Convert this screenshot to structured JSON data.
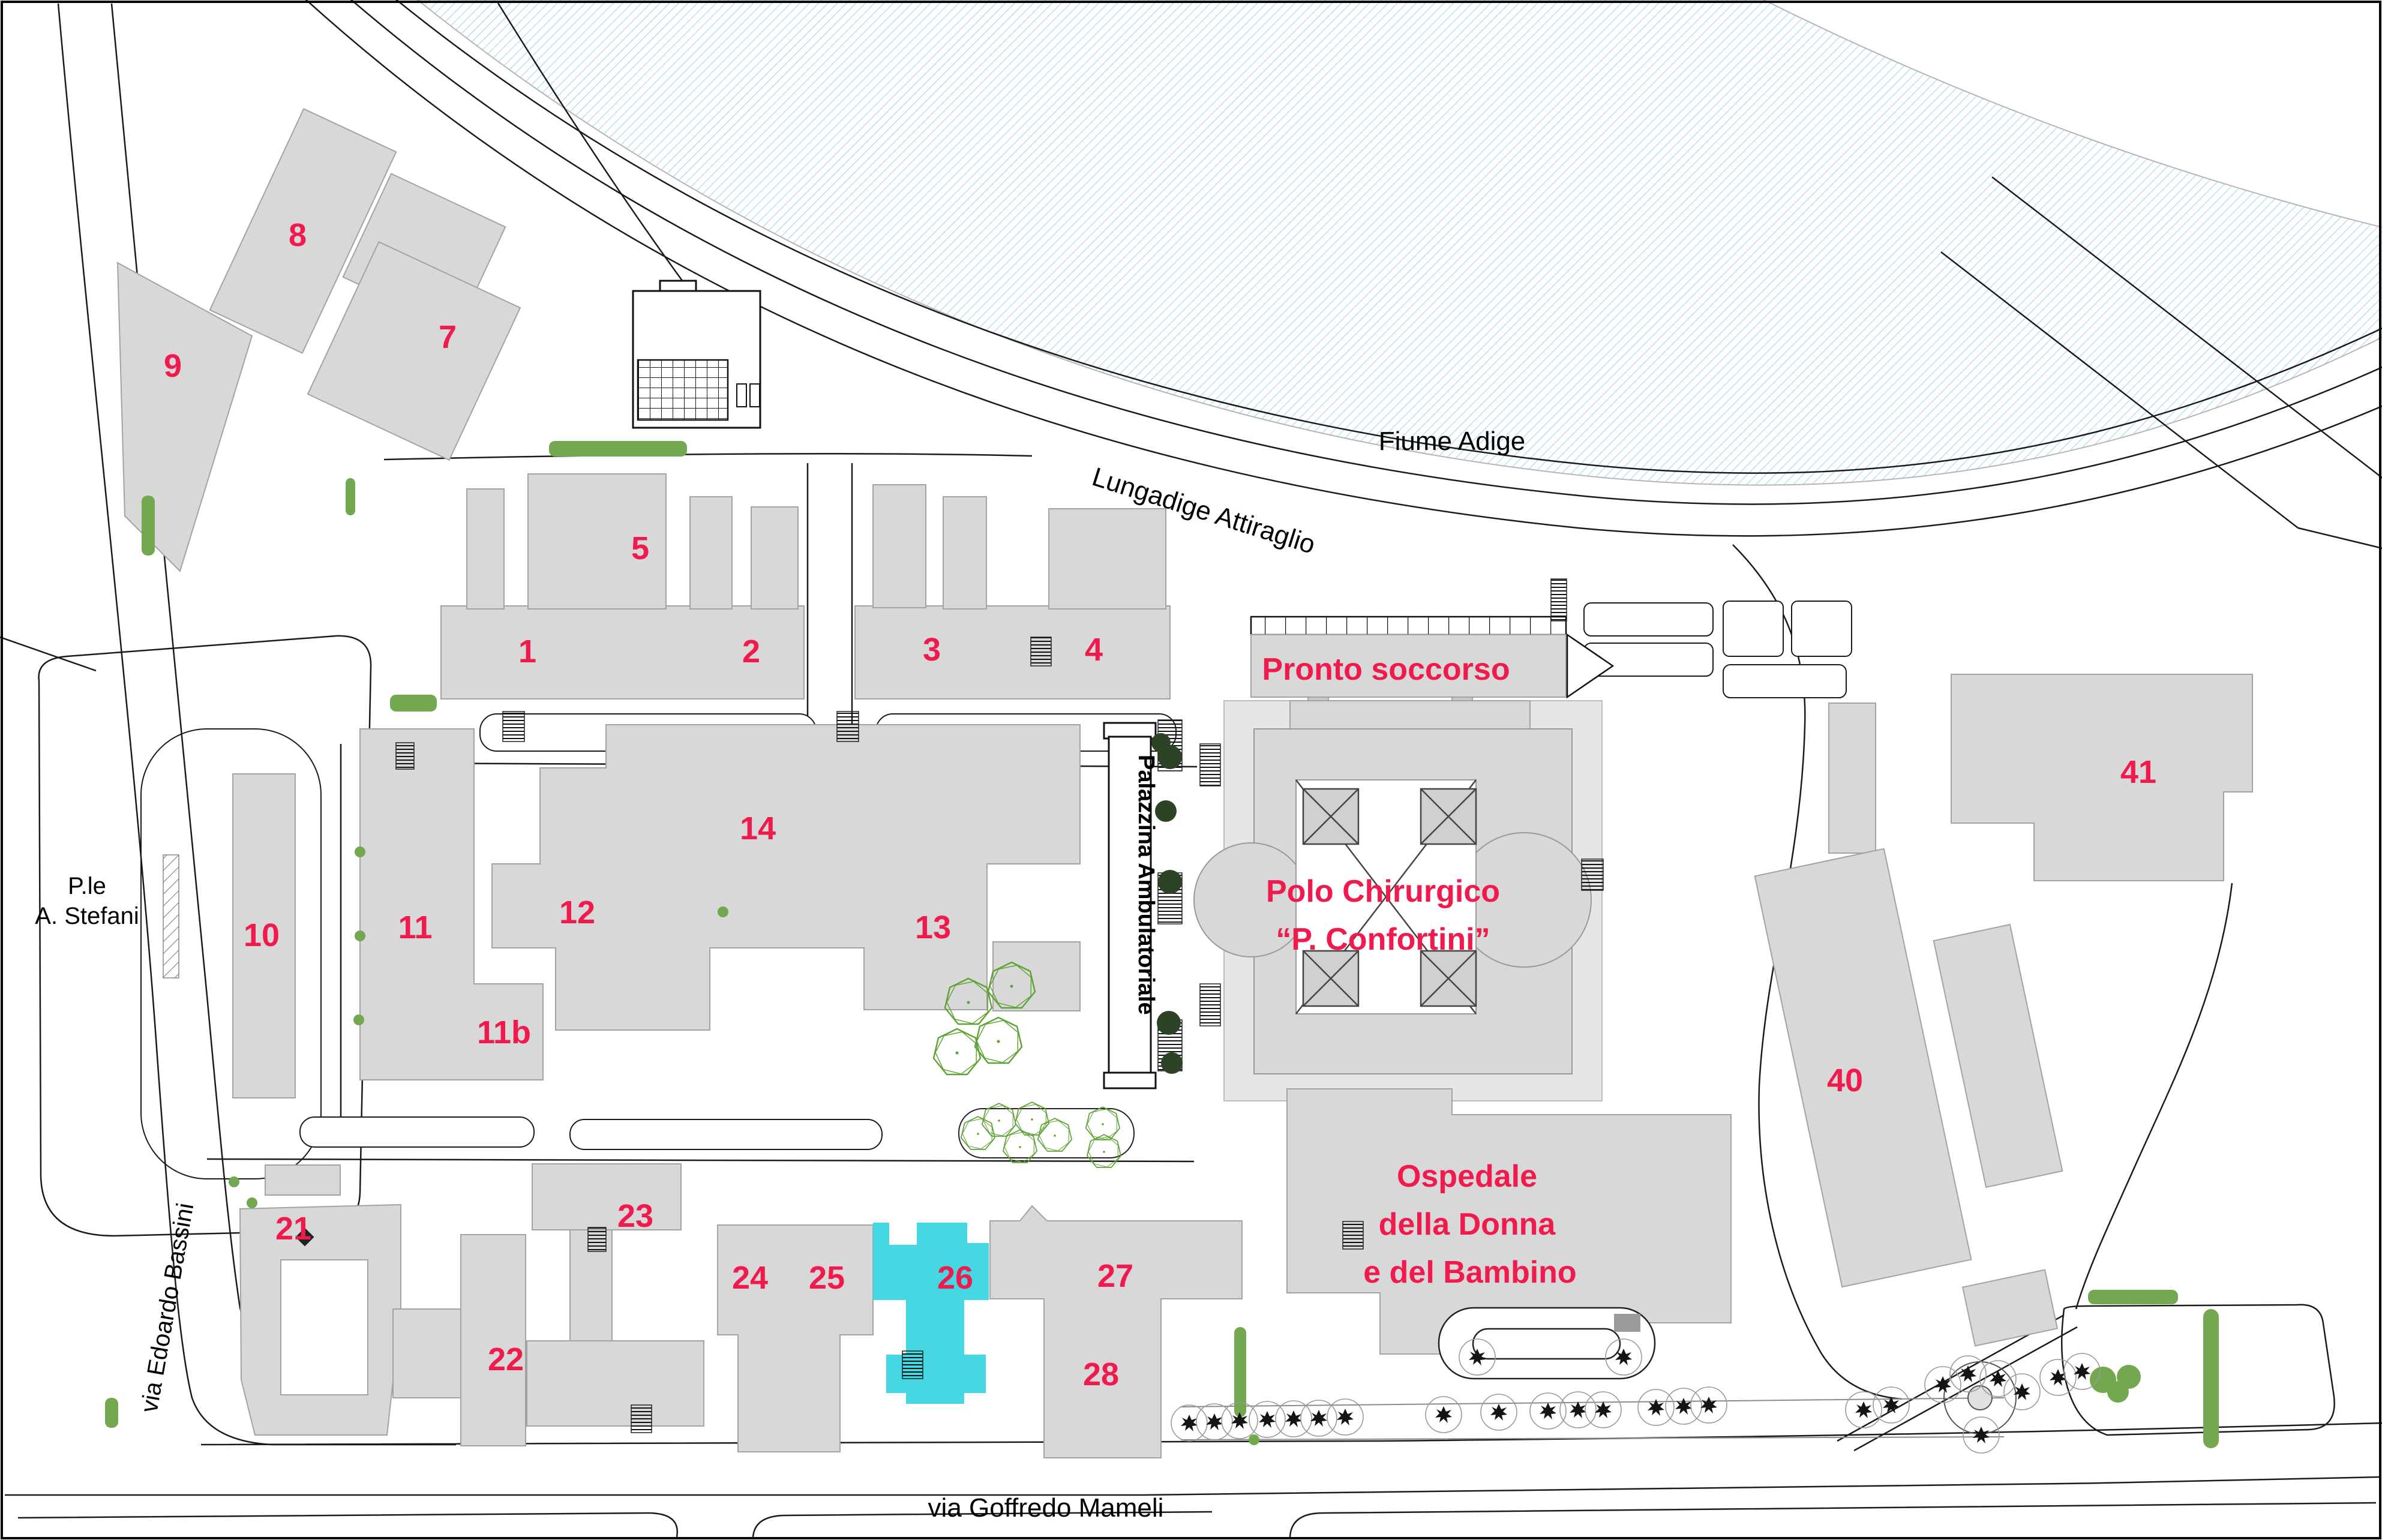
{
  "map": {
    "region_labels": {
      "river": "Fiume Adige"
    },
    "streets": {
      "lungadige_attiraglio": "Lungadige Attiraglio",
      "via_edoardo_bassini": "via Edoardo Bassini",
      "via_goffredo_mameli": "via Goffredo Mameli",
      "piazzale_line1": "P.le",
      "piazzale_line2": "A. Stefani"
    },
    "facility_labels": {
      "palazzina_ambulatoriale": "Palazzina Ambulatoriale",
      "pronto_soccorso": "Pronto soccorso",
      "polo_chirurgico_line1": "Polo Chirurgico",
      "polo_chirurgico_line2": "“P. Confortini”",
      "ospedale_donna_line1": "Ospedale",
      "ospedale_donna_line2": "della Donna",
      "ospedale_donna_line3": "e del Bambino"
    },
    "buildings": [
      {
        "id": "1",
        "label": "1"
      },
      {
        "id": "2",
        "label": "2"
      },
      {
        "id": "3",
        "label": "3"
      },
      {
        "id": "4",
        "label": "4"
      },
      {
        "id": "5",
        "label": "5"
      },
      {
        "id": "7",
        "label": "7"
      },
      {
        "id": "8",
        "label": "8"
      },
      {
        "id": "9",
        "label": "9"
      },
      {
        "id": "10",
        "label": "10"
      },
      {
        "id": "11",
        "label": "11"
      },
      {
        "id": "11b",
        "label": "11b"
      },
      {
        "id": "12",
        "label": "12"
      },
      {
        "id": "13",
        "label": "13"
      },
      {
        "id": "14",
        "label": "14"
      },
      {
        "id": "21",
        "label": "21"
      },
      {
        "id": "22",
        "label": "22"
      },
      {
        "id": "23",
        "label": "23"
      },
      {
        "id": "24",
        "label": "24"
      },
      {
        "id": "25",
        "label": "25"
      },
      {
        "id": "26",
        "label": "26"
      },
      {
        "id": "27",
        "label": "27"
      },
      {
        "id": "28",
        "label": "28"
      },
      {
        "id": "40",
        "label": "40"
      },
      {
        "id": "41",
        "label": "41"
      }
    ],
    "highlighted_building": "26",
    "colors": {
      "building_fill": "#d8d8d8",
      "highlight_fill": "#45d7e2",
      "label_red": "#f01a4d",
      "river_hatch": "#9fd8ec",
      "vegetation_green": "#74a850",
      "tree_dark": "#2c4326"
    }
  }
}
